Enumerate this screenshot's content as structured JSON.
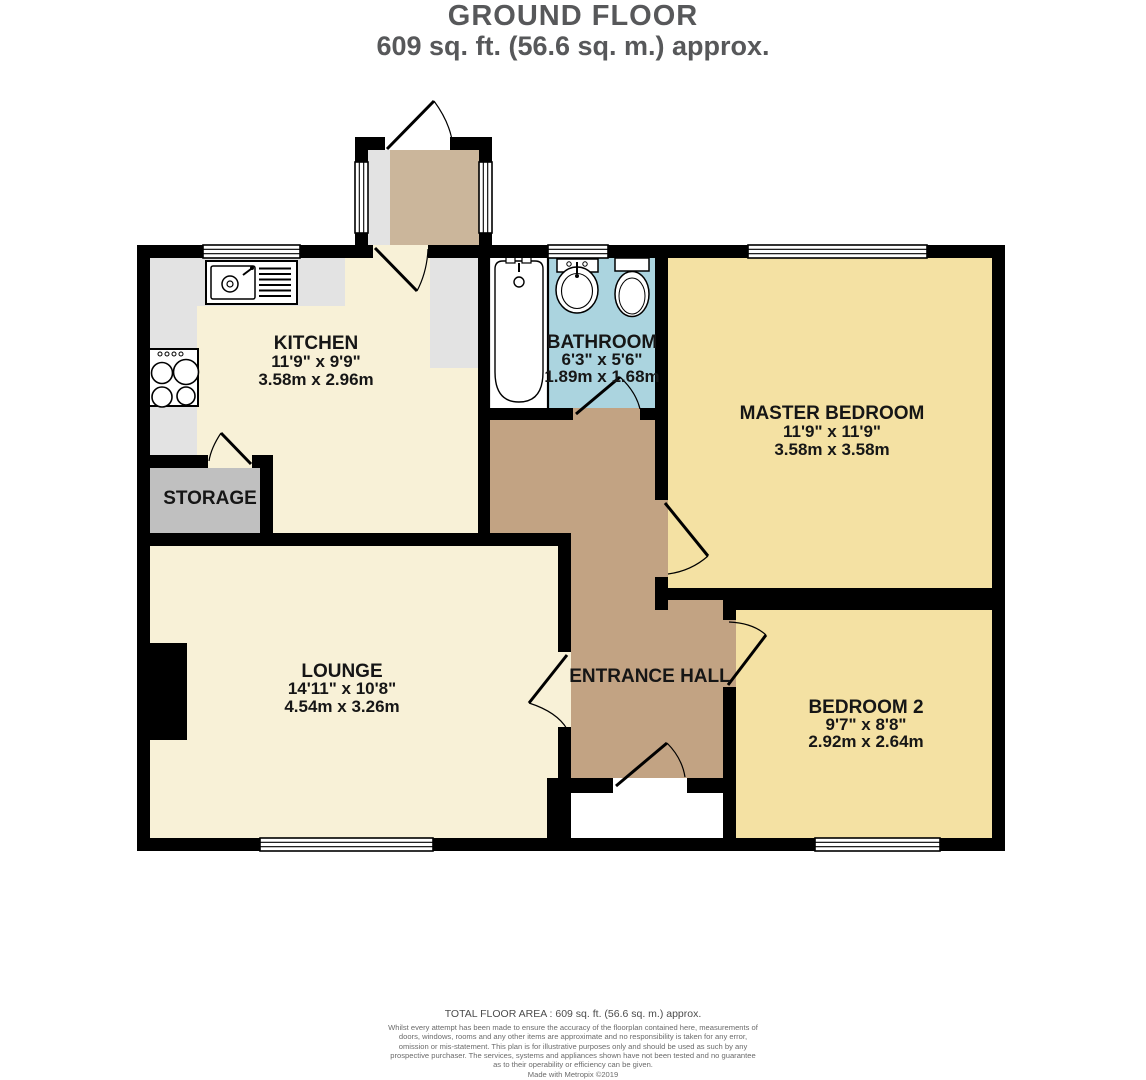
{
  "title": {
    "floor": "GROUND FLOOR",
    "area": "609 sq. ft. (56.6 sq. m.) approx."
  },
  "rooms": {
    "kitchen": {
      "name": "KITCHEN",
      "imperial": "11'9\" x 9'9\"",
      "metric": "3.58m x 2.96m"
    },
    "bathroom": {
      "name": "BATHROOM",
      "imperial": "6'3\" x 5'6\"",
      "metric": "1.89m x 1.68m"
    },
    "master_bedroom": {
      "name": "MASTER BEDROOM",
      "imperial": "11'9\" x 11'9\"",
      "metric": "3.58m x 3.58m"
    },
    "storage": {
      "name": "STORAGE"
    },
    "lounge": {
      "name": "LOUNGE",
      "imperial": "14'11\" x 10'8\"",
      "metric": "4.54m x 3.26m"
    },
    "entrance_hall": {
      "name": "ENTRANCE HALL"
    },
    "bedroom_2": {
      "name": "BEDROOM 2",
      "imperial": "9'7\" x 8'8\"",
      "metric": "2.92m x 2.64m"
    }
  },
  "footer": {
    "total_area": "TOTAL FLOOR AREA : 609 sq. ft. (56.6 sq. m.) approx.",
    "disclaimer": "Whilst every attempt has been made to ensure the accuracy of the floorplan contained here, measurements of doors, windows, rooms and any other items are approximate and no responsibility is taken for any error, omission or mis-statement. This plan is for illustrative purposes only and should be used as such by any prospective purchaser. The services, systems and appliances shown have not been tested and no guarantee as to their operability or efficiency can be given.",
    "credit": "Made with Metropix ©2019"
  },
  "colors": {
    "wall": "#000000",
    "cream_floor": "#F8F1D7",
    "bedroom_floor": "#F4E1A3",
    "bathroom_floor": "#ABD4DF",
    "hall_floor": "#C2A383",
    "porch_floor": "#CBB69B",
    "storage_floor": "#C0C0C0",
    "counter": "#E3E3E3",
    "title_text": "#57585A"
  }
}
